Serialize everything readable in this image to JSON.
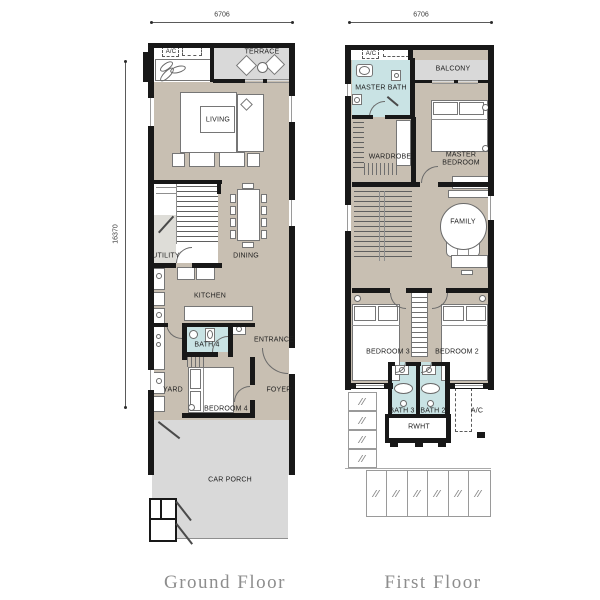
{
  "dims": {
    "ground_width": "6706",
    "first_width": "6706",
    "height": "16370"
  },
  "ground": {
    "caption": "Ground Floor",
    "labels": {
      "ac": "A/C",
      "terrace": "TERRACE",
      "living": "LIVING",
      "utility": "UTILITY",
      "dining": "DINING",
      "kitchen": "KITCHEN",
      "bath4": "BATH 4",
      "entrance": "ENTRANCE",
      "yard": "YARD",
      "bedroom4": "BEDROOM 4",
      "foyer": "FOYER",
      "car_porch": "CAR PORCH"
    }
  },
  "first": {
    "caption": "First Floor",
    "labels": {
      "ac_top": "A/C",
      "master_bath": "MASTER BATH",
      "balcony": "BALCONY",
      "wardrobe": "WARDROBE",
      "master_bedroom": "MASTER BEDROOM",
      "family": "FAMILY",
      "bedroom3": "BEDROOM 3",
      "bedroom2": "BEDROOM 2",
      "bath3": "BATH 3",
      "bath2": "BATH 2",
      "ac_bottom": "A/C",
      "rwht": "RWHT"
    }
  },
  "colors": {
    "floor_tan": "#c8bfb2",
    "outdoor_gray": "#d9d9d9",
    "bath_teal": "#c9e3e4",
    "wall_black": "#181818",
    "caption_gray": "#8d8d8d"
  }
}
